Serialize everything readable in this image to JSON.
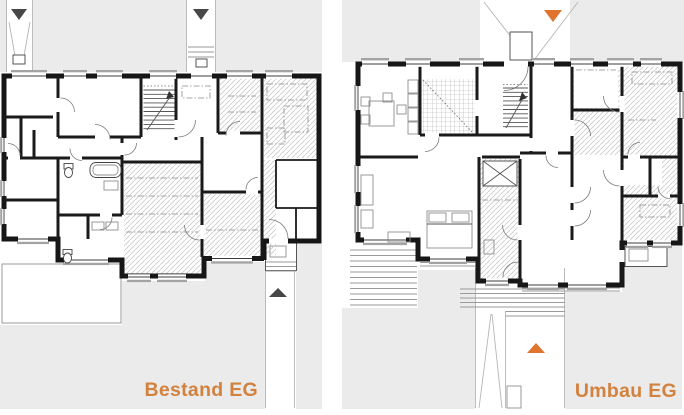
{
  "image": {
    "kind": "architectural floor plan comparison, ground floor before and after conversion",
    "width_px": 684,
    "height_px": 415
  },
  "plans": [
    {
      "id": "bestand",
      "label": "Bestand EG"
    },
    {
      "id": "umbau",
      "label": "Umbau EG"
    }
  ],
  "colors": {
    "background": "#ffffff",
    "surround_gray": "#ebebeb",
    "wall": "#161616",
    "hatch": "#c9c9c9",
    "sill_gray": "#a3a3a3",
    "label_orange": "#d2823e",
    "marker_orange": "#e0742f",
    "marker_dark": "#474747"
  },
  "icons": {
    "entry_marker_down": "triangle pointing down (entrance from street)",
    "entry_marker_up": "triangle pointing up (entrance from garden side)"
  }
}
